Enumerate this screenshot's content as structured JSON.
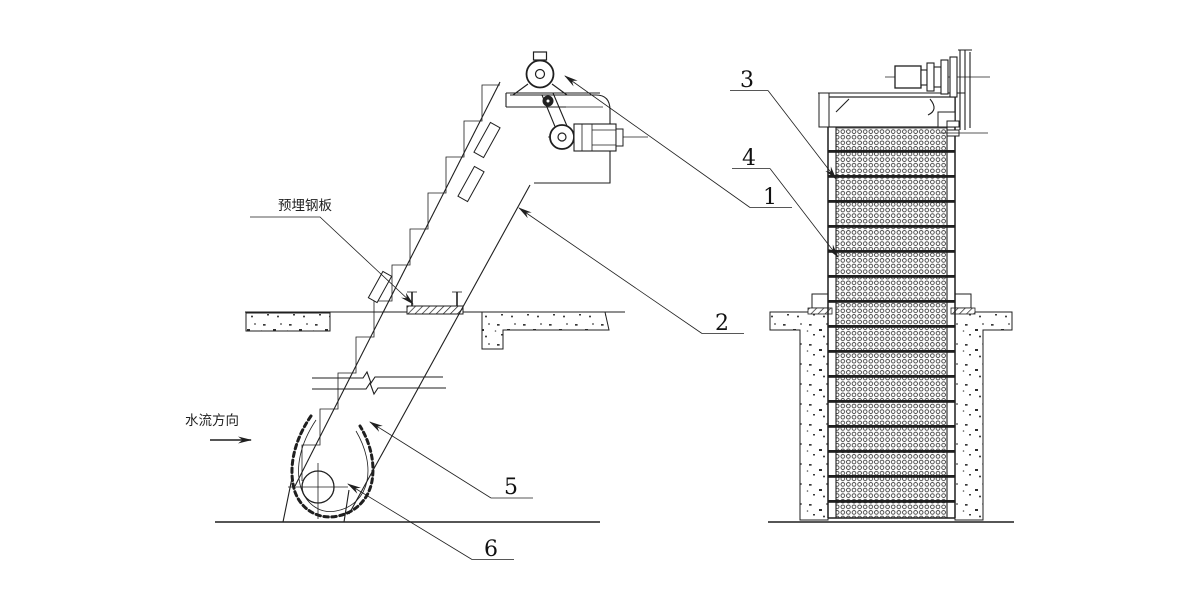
{
  "meta": {
    "kind": "technical-engineering-drawing",
    "views": [
      "side-elevation",
      "front-elevation"
    ]
  },
  "colors": {
    "ink": "#1f1f1f",
    "paper": "#ffffff"
  },
  "labels": {
    "embedded_plate": "预埋钢板",
    "flow_direction": "水流方向"
  },
  "callouts": {
    "c1": "1",
    "c2": "2",
    "c3": "3",
    "c4": "4",
    "c5": "5",
    "c6": "6"
  }
}
